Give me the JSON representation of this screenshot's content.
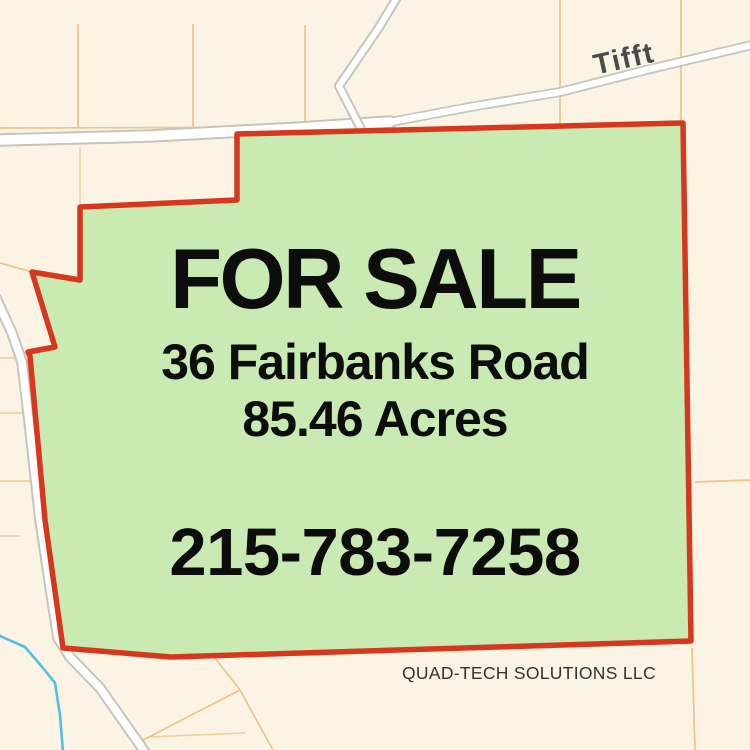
{
  "map": {
    "road_label": "Tifft",
    "colors": {
      "background": "#fbf4e5",
      "parcel_line": "#edc489",
      "road_casing": "#c7c4be",
      "road_fill": "#ffffff",
      "stream": "#55bede",
      "parcel_fill": "#c9eab3",
      "parcel_border": "#d6371d",
      "road_label": "#4a4a4a",
      "text": "#0d0d0d",
      "company_text": "#333333"
    }
  },
  "overlay": {
    "headline": "FOR SALE",
    "address": "36 Fairbanks Road",
    "acreage": "85.46 Acres",
    "phone": "215-783-7258",
    "company": "QUAD-TECH SOLUTIONS LLC"
  }
}
